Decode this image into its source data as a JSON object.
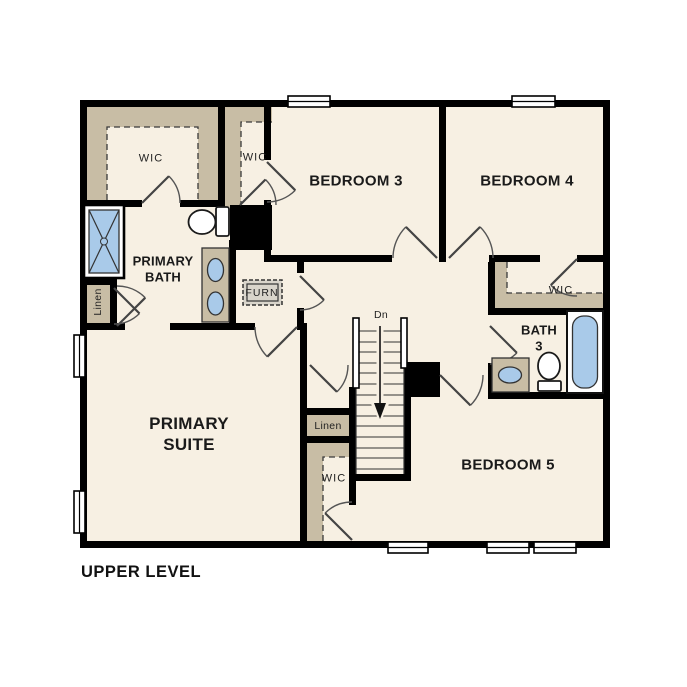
{
  "title": "UPPER LEVEL",
  "labels": {
    "wic_primary": "WIC",
    "wic_hall": "WIC",
    "wic_bedroom4": "WIC",
    "wic_bedroom5": "WIC",
    "bedroom3": "BEDROOM 3",
    "bedroom4": "BEDROOM 4",
    "bedroom5": "BEDROOM 5",
    "primary_bath_1": "PRIMARY",
    "primary_bath_2": "BATH",
    "primary_suite_1": "PRIMARY",
    "primary_suite_2": "SUITE",
    "bath3_1": "BATH",
    "bath3_2": "3",
    "furnace": "FURN",
    "linen_bath": "Linen",
    "linen_hall": "Linen",
    "stairs_direction": "Dn"
  },
  "colors": {
    "wall": "#000000",
    "floor": "#f7f0e3",
    "closet_shelf": "#c8bda5",
    "fixture_blue": "#a9cae9",
    "furnace_fill": "#d9d5cb"
  },
  "fixtures": [
    "shower",
    "toilet-primary",
    "double-vanity",
    "furnace",
    "vanity-bath3",
    "toilet-bath3",
    "bathtub"
  ],
  "stairs": {
    "treads": 14,
    "direction": "down"
  }
}
